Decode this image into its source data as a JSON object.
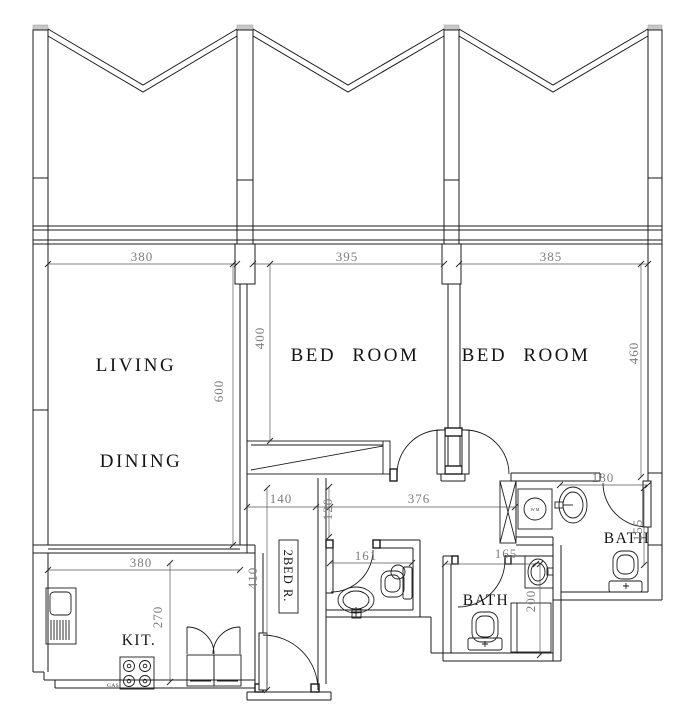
{
  "rooms": {
    "living": "LIVING",
    "dining": "DINING",
    "bedroom1": "BED ROOM",
    "bedroom2": "BED ROOM",
    "kitchen": "KIT.",
    "bath1": "BATH",
    "bath2": "BATH",
    "unit": "2BED R."
  },
  "fixtures": {
    "washing_machine": "W.M",
    "gas_stove": "GAS"
  },
  "dims": {
    "living_w": "380",
    "bed1_w": "395",
    "bed2_w": "385",
    "bed1_d": "400",
    "living_d": "600",
    "bed2_d": "460",
    "hall_a": "140",
    "hall_b": "120",
    "hall_c": "376",
    "bath1_w": "180",
    "kitchen_w": "380",
    "kitchen_d": "270",
    "corridor_d": "410",
    "wc_w": "161",
    "bath2_w": "165",
    "bath2_d": "200",
    "bath1_d": "155"
  },
  "colors": {
    "line": "#1b1b1b",
    "dim_text": "#7d7d7d",
    "dim_line": "#5a5a5a",
    "pillar_cap": "#c8c8c8",
    "background": "#ffffff"
  }
}
